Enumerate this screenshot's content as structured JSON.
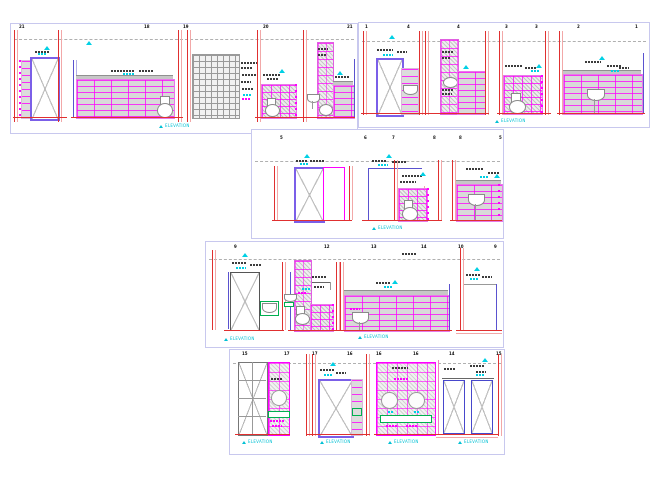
{
  "drawing": {
    "colors": {
      "wall_axis_red": "#e03030",
      "tile_magenta": "#ff00ff",
      "annotation_cyan": "#00d0e4",
      "door_frame_purple": "#7b5fe8",
      "door_frame_blue": "#4747cc",
      "fixture_gray": "#8a8a8a",
      "shelf_green": "#00b050",
      "panel_border": "#c8c8ee"
    },
    "panels": [
      {
        "name": "sanitary-elevations-sheet-1",
        "bubbles": [
          "21",
          "18",
          "19",
          "20",
          "21"
        ],
        "captions": [
          "ELEVATION"
        ]
      },
      {
        "name": "sanitary-elevations-sheet-2",
        "bubbles": [
          "1",
          "4",
          "4",
          "3",
          "3",
          "2",
          "1"
        ],
        "captions": [
          "ELEVATION"
        ]
      },
      {
        "name": "sanitary-elevations-sheet-3",
        "bubbles": [
          "5",
          "6",
          "7",
          "8",
          "8",
          "5"
        ],
        "captions": [
          "ELEVATION"
        ]
      },
      {
        "name": "sanitary-elevations-sheet-4",
        "bubbles": [
          "9",
          "12",
          "13",
          "14",
          "10",
          "9"
        ],
        "captions": [
          "ELEVATION",
          "ELEVATION"
        ]
      },
      {
        "name": "sanitary-elevations-sheet-5",
        "bubbles": [
          "15",
          "17",
          "17",
          "16",
          "16",
          "16",
          "14",
          "15"
        ],
        "captions": [
          "ELEVATION",
          "ELEVATION",
          "ELEVATION",
          "ELEVATION"
        ]
      }
    ]
  }
}
